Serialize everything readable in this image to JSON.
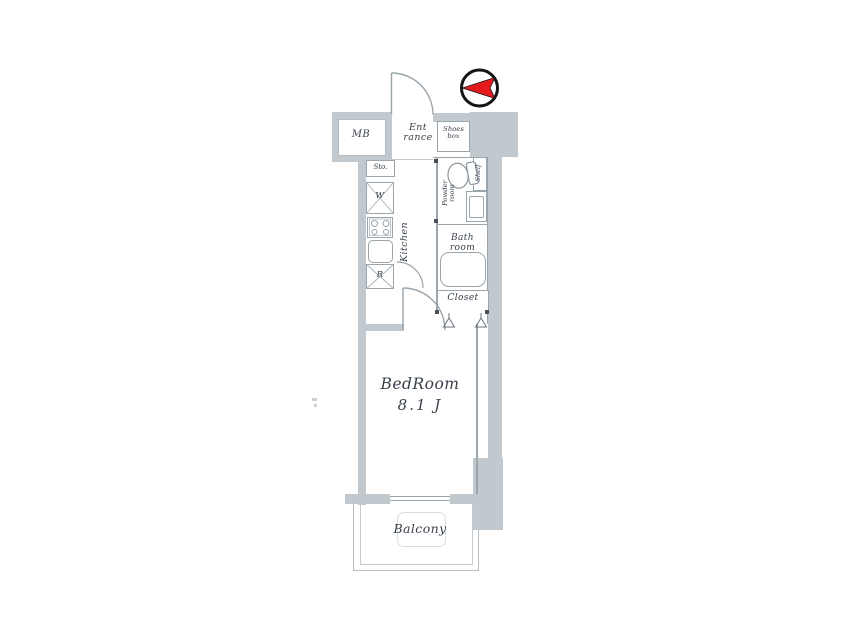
{
  "palette": {
    "wall_gray": "#c2c9ce",
    "line_gray": "#9ba5ac",
    "text_dark": "#39404b",
    "compass_red": "#e6191d"
  },
  "labels": {
    "mb": "MB",
    "entrance": [
      "Ent",
      "rance"
    ],
    "shoes_box": [
      "Shoes",
      "box"
    ],
    "storage": "Sto.",
    "washer": "W",
    "kitchen": "Kitchen",
    "fridge": "R",
    "powder_room": [
      "Powder",
      "room"
    ],
    "shelf": "Shelf",
    "bath_room": [
      "Bath",
      "room"
    ],
    "closet": "Closet",
    "bedroom": "BedRoom",
    "bedroom_size": "8.1 J",
    "balcony": "Balcony"
  }
}
